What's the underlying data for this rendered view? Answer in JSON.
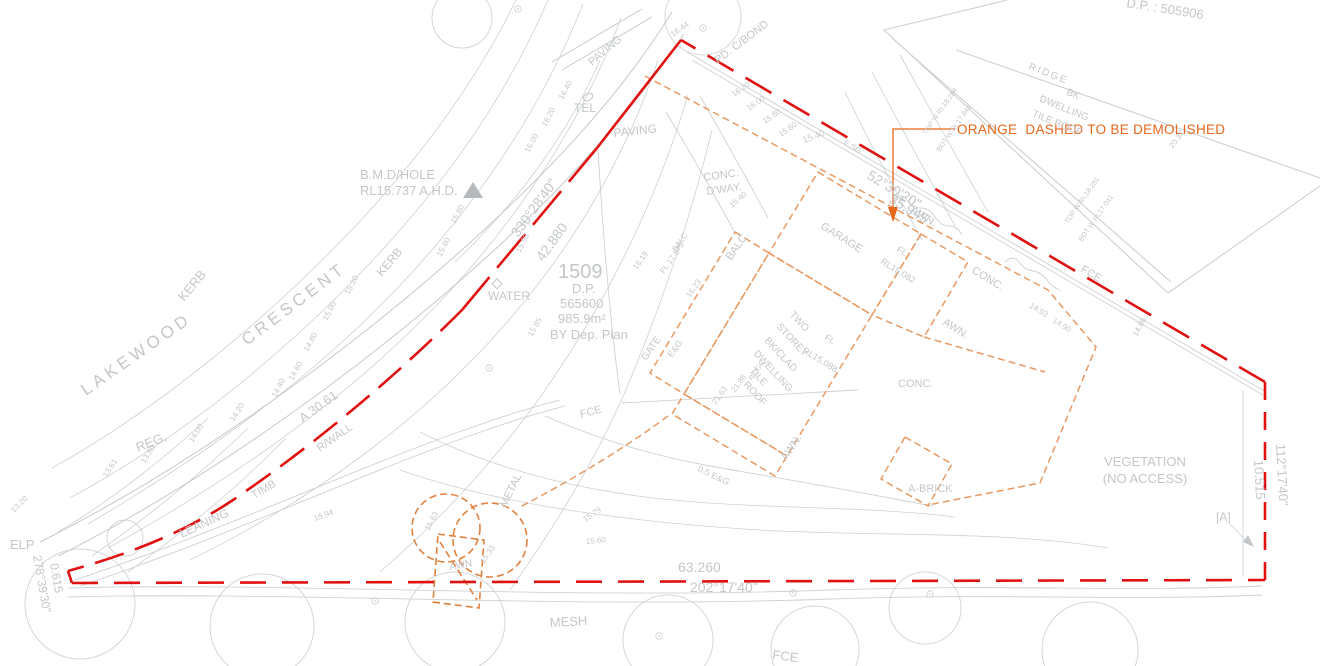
{
  "colors": {
    "boundary_red": "#e01111",
    "orange_note": "#e8661a",
    "orange_line": "#e79a63",
    "orange_strong": "#e0823f",
    "gray_text": "#c3c7c9",
    "gray_line": "#cdd1d3",
    "gray_dark": "#b5b9bb"
  },
  "note": {
    "text": "ORANGE  DASHED TO BE DEMOLISHED"
  },
  "labels": [
    {
      "n": "street-name-lakewood",
      "t": "LAKEWOOD",
      "x": 86,
      "y": 396,
      "r": -35,
      "s": 17,
      "ls": 4
    },
    {
      "n": "street-name-crescent",
      "t": "CRESCENT",
      "x": 247,
      "y": 346,
      "r": -37,
      "s": 17,
      "ls": 4
    },
    {
      "n": "benchmark-line1",
      "t": "B.M.D/HOLE",
      "x": 360,
      "y": 179,
      "s": 13
    },
    {
      "n": "benchmark-line2",
      "t": "RL15.737 A.H.D.",
      "x": 360,
      "y": 195,
      "s": 13
    },
    {
      "n": "kerb-label",
      "t": "KERB",
      "x": 184,
      "y": 302,
      "r": -50,
      "s": 13
    },
    {
      "n": "kerb-label-2",
      "t": "KERB",
      "x": 382,
      "y": 277,
      "r": -50,
      "s": 12
    },
    {
      "n": "reg-label",
      "t": "REG.",
      "x": 138,
      "y": 452,
      "r": -22,
      "s": 13
    },
    {
      "n": "elp-label",
      "t": "ELP",
      "x": 10,
      "y": 549,
      "s": 13
    },
    {
      "n": "water-label",
      "t": "WATER",
      "x": 488,
      "y": 300,
      "s": 12
    },
    {
      "n": "tel-label",
      "t": "TEL",
      "x": 574,
      "y": 112,
      "s": 12
    },
    {
      "n": "paving-label-1",
      "t": "PAVING",
      "x": 592,
      "y": 66,
      "r": -40,
      "s": 11
    },
    {
      "n": "paving-label-2",
      "t": "PAVING",
      "x": 614,
      "y": 137,
      "r": -6,
      "s": 12
    },
    {
      "n": "fence-colorbond-label",
      "t": "PD. C/BOND",
      "x": 718,
      "y": 64,
      "r": -37,
      "s": 11
    },
    {
      "n": "conc-dway-1",
      "t": "CONC.",
      "x": 704,
      "y": 181,
      "r": -8,
      "s": 11
    },
    {
      "n": "conc-dway-2",
      "t": "D'WAY.",
      "x": 707,
      "y": 195,
      "r": -8,
      "s": 11
    },
    {
      "n": "lot-number",
      "t": "1509",
      "x": 558,
      "y": 278,
      "s": 20
    },
    {
      "n": "lot-dp",
      "t": "D.P.",
      "x": 572,
      "y": 293,
      "s": 13
    },
    {
      "n": "lot-dp-number",
      "t": "565600",
      "x": 560,
      "y": 308,
      "s": 13
    },
    {
      "n": "lot-area",
      "t": "985.9m²",
      "x": 558,
      "y": 323,
      "s": 13
    },
    {
      "n": "lot-by-dep-plan",
      "t": "BY Dep. Plan",
      "x": 550,
      "y": 339,
      "s": 13
    },
    {
      "n": "bearing-nw",
      "t": "330°28'40\"",
      "x": 518,
      "y": 238,
      "r": -54,
      "s": 14
    },
    {
      "n": "distance-nw",
      "t": "42.880",
      "x": 543,
      "y": 262,
      "r": -54,
      "s": 14
    },
    {
      "n": "bearing-ne",
      "t": "52°30'20\"",
      "x": 866,
      "y": 178,
      "r": 31,
      "s": 14
    },
    {
      "n": "distance-ne",
      "t": "35.945",
      "x": 888,
      "y": 202,
      "r": 31,
      "s": 14
    },
    {
      "n": "distance-south",
      "t": "63.260",
      "x": 678,
      "y": 572,
      "s": 14
    },
    {
      "n": "bearing-south",
      "t": "202°17'40\"",
      "x": 690,
      "y": 592,
      "s": 14
    },
    {
      "n": "bearing-east",
      "t": "112°17'40\"",
      "x": 1276,
      "y": 444,
      "r": 87,
      "s": 13
    },
    {
      "n": "distance-east",
      "t": "10.515",
      "x": 1254,
      "y": 460,
      "r": 87,
      "s": 13
    },
    {
      "n": "distance-sw",
      "t": "0.615",
      "x": 50,
      "y": 564,
      "r": 80,
      "s": 12
    },
    {
      "n": "bearing-sw",
      "t": "278°39'30\"",
      "x": 33,
      "y": 556,
      "r": 80,
      "s": 12
    },
    {
      "n": "arc-length",
      "t": "A 30.61",
      "x": 303,
      "y": 423,
      "r": -36,
      "s": 13
    },
    {
      "n": "garage-label",
      "t": "GARAGE",
      "x": 820,
      "y": 228,
      "r": 32,
      "s": 11
    },
    {
      "n": "garage-fl-1",
      "t": "FL",
      "x": 896,
      "y": 251,
      "r": 32,
      "s": 9
    },
    {
      "n": "garage-fl-2",
      "t": "RL15.082",
      "x": 880,
      "y": 263,
      "r": 32,
      "s": 9
    },
    {
      "n": "dwelling-line-1",
      "t": "TWO",
      "x": 789,
      "y": 315,
      "r": 47,
      "s": 10
    },
    {
      "n": "dwelling-line-2",
      "t": "STOREY",
      "x": 776,
      "y": 327,
      "r": 47,
      "s": 10
    },
    {
      "n": "dwelling-line-3",
      "t": "BK/CLAD",
      "x": 764,
      "y": 341,
      "r": 47,
      "s": 10
    },
    {
      "n": "dwelling-line-4",
      "t": "DWELLING",
      "x": 753,
      "y": 354,
      "r": 47,
      "s": 10
    },
    {
      "n": "dwelling-line-5",
      "t": "TILE",
      "x": 749,
      "y": 371,
      "r": 47,
      "s": 10
    },
    {
      "n": "dwelling-line-6",
      "t": "ROOF",
      "x": 743,
      "y": 385,
      "r": 47,
      "s": 10
    },
    {
      "n": "dwelling-fl-1",
      "t": "FL",
      "x": 824,
      "y": 339,
      "r": 32,
      "s": 9
    },
    {
      "n": "dwelling-fl-2",
      "t": "RL15.088",
      "x": 802,
      "y": 352,
      "r": 32,
      "s": 9
    },
    {
      "n": "balc-label",
      "t": "BALC.",
      "x": 731,
      "y": 261,
      "r": -55,
      "s": 11
    },
    {
      "n": "balc-small",
      "t": "BALC",
      "x": 676,
      "y": 252,
      "r": -55,
      "s": 8
    },
    {
      "n": "balc-fl",
      "t": "FL 17.879",
      "x": 664,
      "y": 274,
      "r": -55,
      "s": 8
    },
    {
      "n": "awn-label-1",
      "t": "AWN.",
      "x": 910,
      "y": 212,
      "r": 32,
      "s": 11
    },
    {
      "n": "awn-label-2",
      "t": "AWN.",
      "x": 942,
      "y": 324,
      "r": 32,
      "s": 11
    },
    {
      "n": "awn-label-3",
      "t": "AWN.",
      "x": 786,
      "y": 461,
      "r": -55,
      "s": 11
    },
    {
      "n": "awn-label-4",
      "t": "AWN",
      "x": 450,
      "y": 570,
      "r": -10,
      "s": 10
    },
    {
      "n": "conc-label-1",
      "t": "CONC.",
      "x": 971,
      "y": 272,
      "r": 32,
      "s": 11
    },
    {
      "n": "conc-label-2",
      "t": "CONC.",
      "x": 898,
      "y": 387,
      "s": 11
    },
    {
      "n": "abrick-label",
      "t": "A-BRICK",
      "x": 908,
      "y": 492,
      "s": 11
    },
    {
      "n": "ridge-spot",
      "t": "RIDGE",
      "x": 752,
      "y": 381,
      "r": -55,
      "s": 7
    },
    {
      "n": "spot-2163",
      "t": "21.63",
      "x": 716,
      "y": 405,
      "r": -55,
      "s": 8
    },
    {
      "n": "spot-2188",
      "t": "21.88",
      "x": 735,
      "y": 393,
      "r": -55,
      "s": 8
    },
    {
      "n": "neighbor-ridge",
      "t": "RIDGE",
      "x": 1028,
      "y": 69,
      "r": 21,
      "s": 10,
      "ls": 2
    },
    {
      "n": "neighbor-line-1",
      "t": "BK",
      "x": 1072,
      "y": 97,
      "r": 22,
      "s": 10,
      "a": "m"
    },
    {
      "n": "neighbor-line-2",
      "t": "DWELLING",
      "x": 1063,
      "y": 111,
      "r": 22,
      "s": 10,
      "a": "m"
    },
    {
      "n": "neighbor-line-3",
      "t": "TILE ROOF",
      "x": 1056,
      "y": 126,
      "r": 22,
      "s": 10,
      "a": "m"
    },
    {
      "n": "neighbor-dp",
      "t": "D.P. : 505906",
      "x": 1126,
      "y": 7,
      "r": 9,
      "s": 13
    },
    {
      "n": "vegetation-1",
      "t": "VEGETATION",
      "x": 1145,
      "y": 466,
      "s": 13,
      "a": "m"
    },
    {
      "n": "vegetation-2",
      "t": "(NO ACCESS)",
      "x": 1145,
      "y": 483,
      "s": 13,
      "a": "m"
    },
    {
      "n": "point-a",
      "t": "[A]",
      "x": 1216,
      "y": 521,
      "s": 12
    },
    {
      "n": "fce-mid",
      "t": "FCE",
      "x": 581,
      "y": 418,
      "r": -15,
      "s": 11
    },
    {
      "n": "fce-ne",
      "t": "FCE",
      "x": 1080,
      "y": 271,
      "r": 31,
      "s": 11
    },
    {
      "n": "fce-bottom",
      "t": "FCE",
      "x": 772,
      "y": 659,
      "r": 7,
      "s": 13
    },
    {
      "n": "mesh-label",
      "t": "MESH",
      "x": 550,
      "y": 627,
      "r": -3,
      "s": 13
    },
    {
      "n": "metal-label",
      "t": "METAL",
      "x": 506,
      "y": 508,
      "r": -64,
      "s": 11
    },
    {
      "n": "leaning-label",
      "t": "LEANING",
      "x": 182,
      "y": 538,
      "r": -25,
      "s": 12
    },
    {
      "n": "timb-label",
      "t": "TIMB",
      "x": 254,
      "y": 499,
      "r": -30,
      "s": 11
    },
    {
      "n": "rwall-label",
      "t": "R/WALL",
      "x": 320,
      "y": 452,
      "r": -35,
      "s": 11
    },
    {
      "n": "gate-label",
      "t": "GATE",
      "x": 646,
      "y": 361,
      "r": -55,
      "s": 10
    },
    {
      "n": "eg-label",
      "t": "E&G",
      "x": 672,
      "y": 358,
      "r": -55,
      "s": 9
    },
    {
      "n": "eg-label-2",
      "t": "0.5 E&G",
      "x": 697,
      "y": 471,
      "r": 25,
      "s": 9
    },
    {
      "n": "esg-label",
      "t": "E.SG",
      "x": 843,
      "y": 144,
      "r": 31,
      "s": 8
    },
    {
      "n": "wall-rl-1",
      "t": "TOP W RL18.284",
      "x": 926,
      "y": 135,
      "r": -55,
      "s": 7
    },
    {
      "n": "wall-rl-2",
      "t": "BOT W RL17.841",
      "x": 940,
      "y": 152,
      "r": -55,
      "s": 7
    },
    {
      "n": "wall-rl-3",
      "t": "TOP W RL18.281",
      "x": 1068,
      "y": 224,
      "r": -55,
      "s": 7
    },
    {
      "n": "wall-rl-4",
      "t": "BOT W RL17.041",
      "x": 1082,
      "y": 242,
      "r": -55,
      "s": 7
    },
    {
      "n": "contour-1644",
      "t": "16.44",
      "x": 673,
      "y": 37,
      "r": -35,
      "s": 8
    },
    {
      "n": "contour-1640",
      "t": "16.40",
      "x": 563,
      "y": 100,
      "r": -62,
      "s": 8
    },
    {
      "n": "contour-1620",
      "t": "16.20",
      "x": 546,
      "y": 127,
      "r": -62,
      "s": 8
    },
    {
      "n": "contour-1600",
      "t": "16.00",
      "x": 529,
      "y": 153,
      "r": -62,
      "s": 8
    },
    {
      "n": "contour-1580",
      "t": "15.80",
      "x": 455,
      "y": 224,
      "r": -62,
      "s": 8
    },
    {
      "n": "contour-1560",
      "t": "15.60",
      "x": 441,
      "y": 257,
      "r": -62,
      "s": 8
    },
    {
      "n": "contour-1520",
      "t": "15.20",
      "x": 349,
      "y": 295,
      "r": -62,
      "s": 8
    },
    {
      "n": "contour-1500",
      "t": "15.00",
      "x": 327,
      "y": 321,
      "r": -62,
      "s": 8
    },
    {
      "n": "contour-1480",
      "t": "14.80",
      "x": 308,
      "y": 352,
      "r": -62,
      "s": 8
    },
    {
      "n": "contour-1460",
      "t": "14.60",
      "x": 293,
      "y": 381,
      "r": -62,
      "s": 8
    },
    {
      "n": "contour-1440",
      "t": "14.40",
      "x": 276,
      "y": 398,
      "r": -62,
      "s": 8
    },
    {
      "n": "contour-1420",
      "t": "14.20",
      "x": 234,
      "y": 422,
      "r": -58,
      "s": 8
    },
    {
      "n": "contour-1400",
      "t": "14.00",
      "x": 193,
      "y": 443,
      "r": -58,
      "s": 8
    },
    {
      "n": "contour-1380",
      "t": "13.80",
      "x": 145,
      "y": 464,
      "r": -58,
      "s": 8
    },
    {
      "n": "contour-1361",
      "t": "13.61",
      "x": 107,
      "y": 478,
      "r": -58,
      "s": 8
    },
    {
      "n": "contour-1320",
      "t": "13.20",
      "x": 14,
      "y": 513,
      "r": -45,
      "s": 8
    },
    {
      "n": "contour-ne-1620",
      "t": "16.20",
      "x": 734,
      "y": 97,
      "r": -35,
      "s": 8
    },
    {
      "n": "contour-ne-1600",
      "t": "16.00",
      "x": 749,
      "y": 111,
      "r": -35,
      "s": 8
    },
    {
      "n": "contour-ne-1580",
      "t": "15.80",
      "x": 765,
      "y": 124,
      "r": -35,
      "s": 8
    },
    {
      "n": "contour-ne-1560",
      "t": "15.60",
      "x": 781,
      "y": 137,
      "r": -35,
      "s": 8
    },
    {
      "n": "contour-ne-1540",
      "t": "15.40",
      "x": 804,
      "y": 143,
      "r": -20,
      "s": 9
    },
    {
      "n": "spot-1540",
      "t": "15.40",
      "x": 732,
      "y": 208,
      "r": -40,
      "s": 8
    },
    {
      "n": "spot-1585",
      "t": "15.85",
      "x": 532,
      "y": 337,
      "r": -60,
      "s": 8
    },
    {
      "n": "spot-1593",
      "t": "15.93",
      "x": 520,
      "y": 253,
      "r": -62,
      "s": 8
    },
    {
      "n": "spot-1623",
      "t": "16.23",
      "x": 690,
      "y": 298,
      "r": -55,
      "s": 8
    },
    {
      "n": "spot-1619",
      "t": "16.19",
      "x": 637,
      "y": 270,
      "r": -55,
      "s": 8
    },
    {
      "n": "spot-1579",
      "t": "15.79",
      "x": 585,
      "y": 522,
      "r": -33,
      "s": 8
    },
    {
      "n": "spot-1560b",
      "t": "15.60",
      "x": 586,
      "y": 544,
      "r": -5,
      "s": 8
    },
    {
      "n": "spot-1563",
      "t": "15.63",
      "x": 429,
      "y": 531,
      "r": -62,
      "s": 8
    },
    {
      "n": "spot-1533",
      "t": "15.33",
      "x": 484,
      "y": 564,
      "r": -55,
      "s": 8
    },
    {
      "n": "spot-1594",
      "t": "15.94",
      "x": 315,
      "y": 521,
      "r": -20,
      "s": 8
    },
    {
      "n": "spot-1486",
      "t": "14.86",
      "x": 1137,
      "y": 337,
      "r": -62,
      "s": 8
    },
    {
      "n": "spot-1493",
      "t": "14.93",
      "x": 1029,
      "y": 307,
      "r": 31,
      "s": 8
    },
    {
      "n": "spot-1490",
      "t": "14.90",
      "x": 1052,
      "y": 322,
      "r": 31,
      "s": 8
    },
    {
      "n": "spot-2032",
      "t": "20.32",
      "x": 1173,
      "y": 149,
      "r": -55,
      "s": 8
    }
  ]
}
